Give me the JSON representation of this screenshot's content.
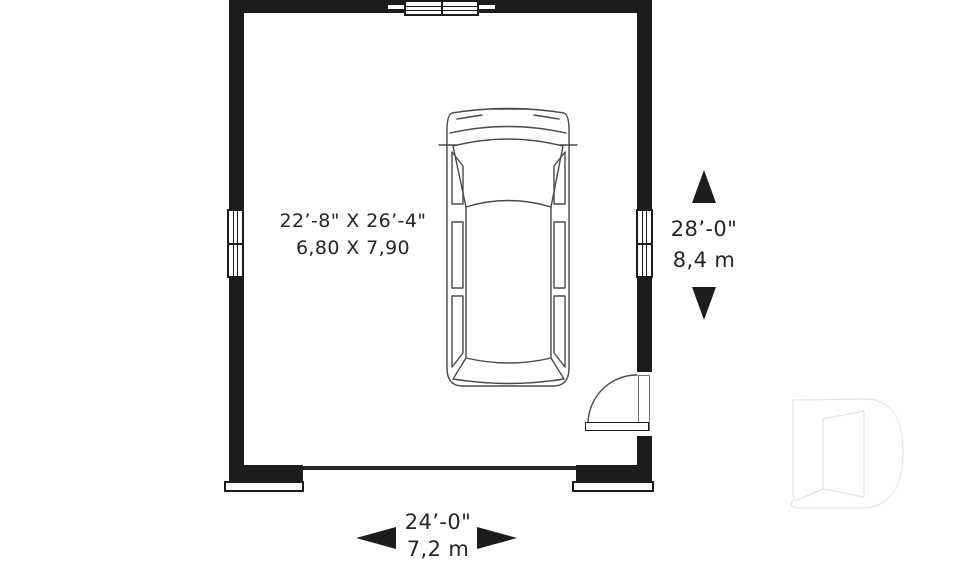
{
  "colors": {
    "background": "#ffffff",
    "wall": "#1c1c1c",
    "line": "#4a4a4a",
    "text": "#262626",
    "logo_outline": "#e5e5e5"
  },
  "dimensions": {
    "interior": {
      "imperial": "22’-8\" X 26’-4\"",
      "metric": "6,80 X 7,90"
    },
    "depth": {
      "imperial": "28’-0\"",
      "metric": "8,4 m"
    },
    "width": {
      "imperial": "24’-0\"",
      "metric": "7,2 m"
    }
  },
  "elements": {
    "vehicle": "minivan-top-view",
    "logo": "drummond-d-logo",
    "door": "single-swing-entry-door",
    "windows": [
      "top-wall-double-window",
      "left-wall-double-window",
      "right-wall-double-window"
    ],
    "garage_opening": "garage-door-opening"
  }
}
